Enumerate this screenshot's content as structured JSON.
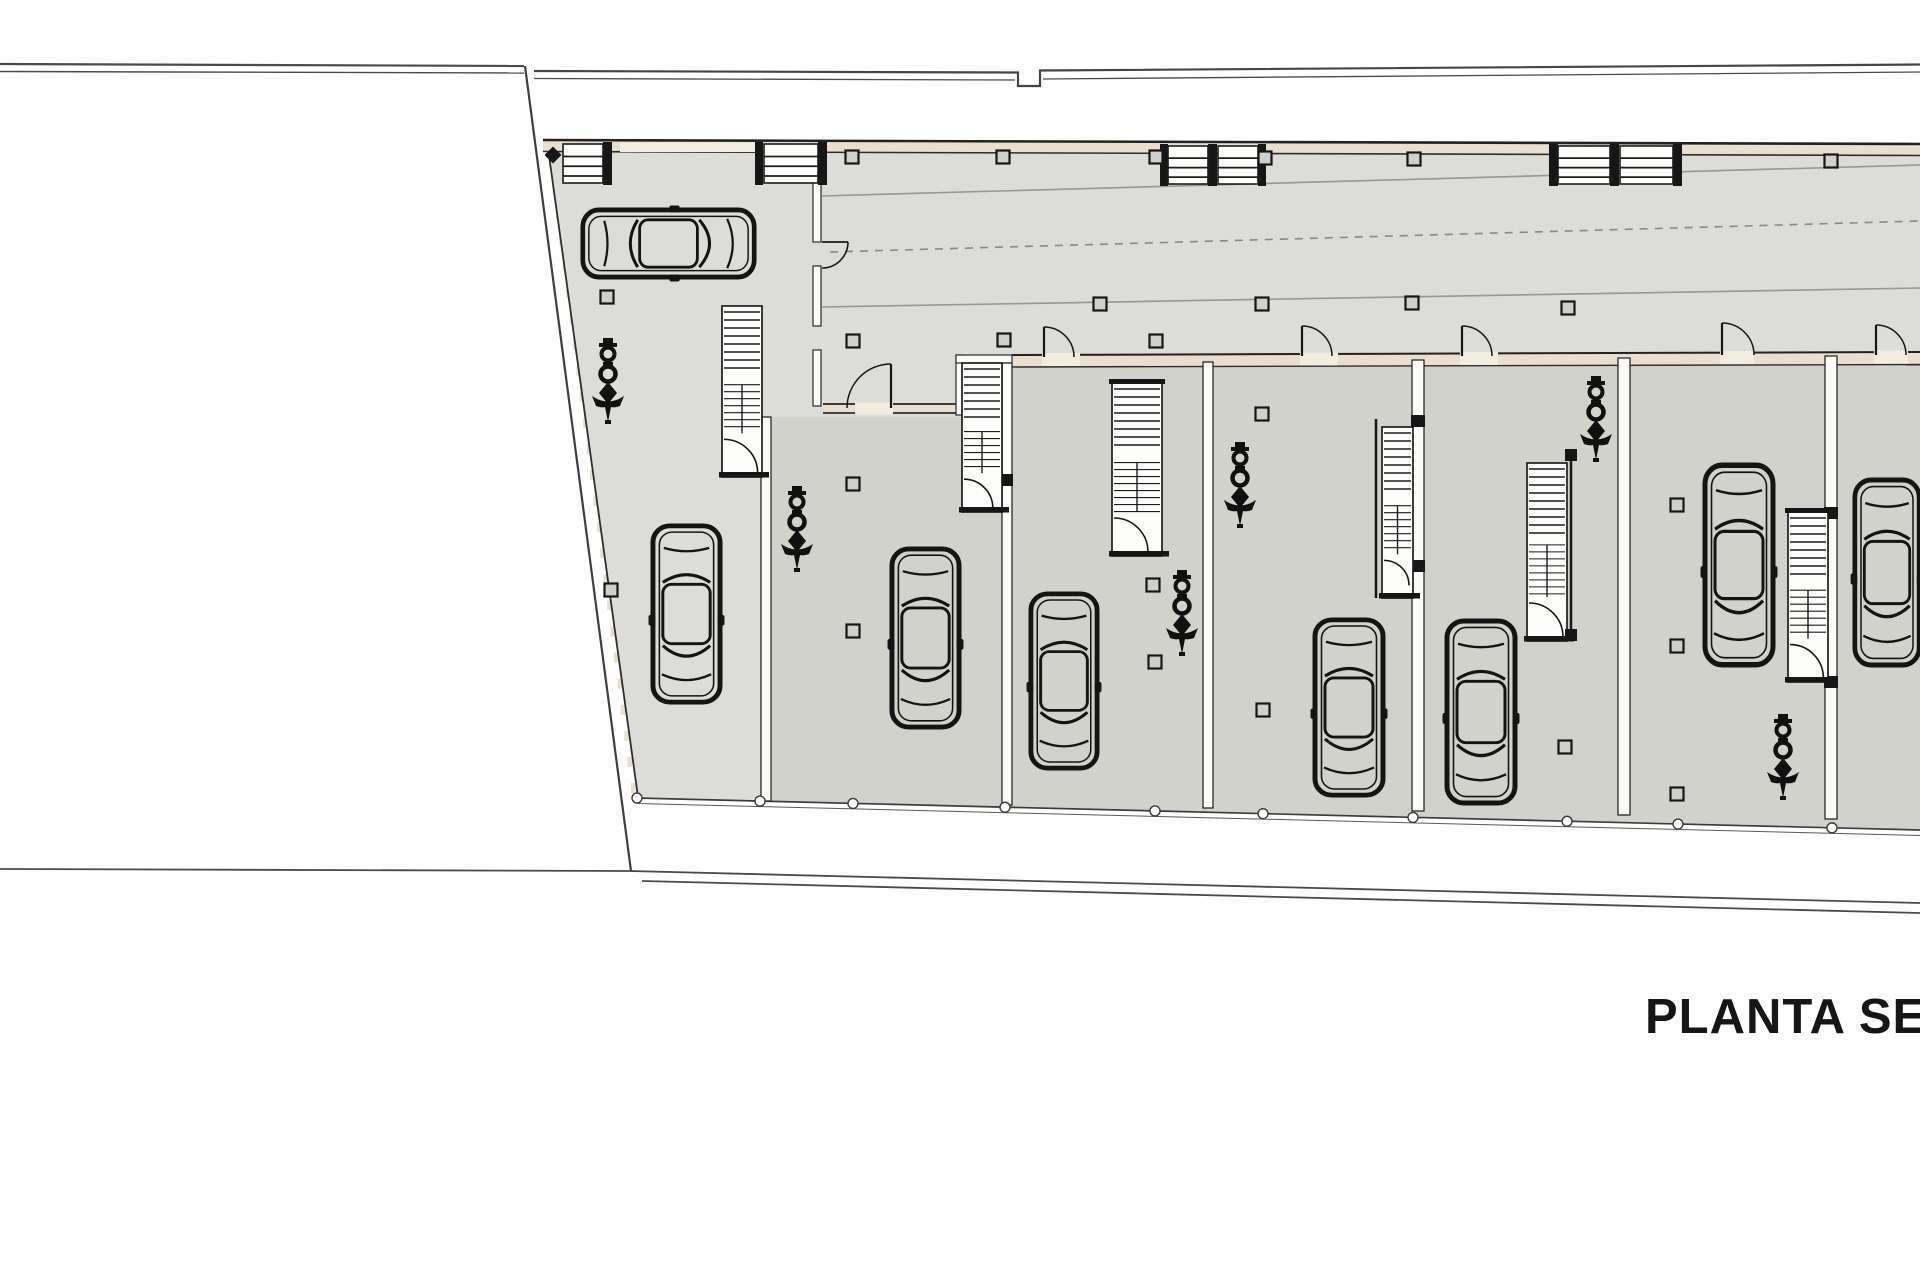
{
  "title": {
    "label": "PLANTA SEMIS"
  },
  "canvas": {
    "w": 1920,
    "h": 1280
  },
  "colors": {
    "background": "#ffffff",
    "floor_light": "#dcdcd8",
    "floor_unit": "#d2d2cc",
    "wall_fill": "#eadfcf",
    "wall_gap": "#f3ecdf",
    "white_wall": "#fcfbf8",
    "ink": "#1a1a1a",
    "boundary": "#4a4a4a",
    "lane": "#98988f"
  },
  "plan": {
    "building_outline": [
      [
        547,
        141
      ],
      [
        1920,
        145
      ],
      [
        1920,
        829
      ],
      [
        638,
        797
      ]
    ],
    "units_overlay": [
      [
        772,
        417
      ],
      [
        1002,
        417
      ],
      [
        1002,
        364
      ],
      [
        1920,
        356
      ],
      [
        1920,
        829
      ],
      [
        772,
        801
      ]
    ],
    "west_edge": {
      "x1": 551,
      "y1": 162,
      "x2": 633,
      "y2": 788,
      "dash_count": 24
    },
    "paths": [
      {
        "name": "boundary-top-left-outer",
        "d": "M0,64 L524,66",
        "w": 2.2,
        "c": "#4a4a4a"
      },
      {
        "name": "boundary-top-left-inner",
        "d": "M0,71.5 L524,73",
        "w": 1.4,
        "c": "#4a4a4a"
      },
      {
        "name": "boundary-top-right-outer",
        "d": "M534,71 L1018,72.5 L1018,86 L1040,86 L1040,70.5 L1920,64.5",
        "w": 2.2,
        "c": "#454545",
        "f": "none"
      },
      {
        "name": "boundary-top-right-inner-a",
        "d": "M534,78.5 L1015,80",
        "w": 1.3,
        "c": "#4a4a4a"
      },
      {
        "name": "boundary-top-right-inner-b",
        "d": "M1043,79 L1920,72",
        "w": 1.3,
        "c": "#4a4a4a"
      },
      {
        "name": "boundary-west-diagonal",
        "d": "M525,66 L631,871",
        "w": 2.2,
        "c": "#3f3f3f"
      },
      {
        "name": "boundary-bottom-left",
        "d": "M0,869 L629,871",
        "w": 1.8,
        "c": "#4a4a4a"
      },
      {
        "name": "boundary-bottom-right-outer",
        "d": "M629,871 L1920,903",
        "w": 1.8,
        "c": "#4a4a4a"
      },
      {
        "name": "boundary-bottom-right-inner",
        "d": "M642,881 L1920,913",
        "w": 1.8,
        "c": "#4a4a4a"
      },
      {
        "name": "building-west-edge",
        "d": "M547,141 L638,797",
        "w": 1.8,
        "c": "#2e2e2e"
      },
      {
        "name": "south-edge-outer",
        "d": "M637,798 L1920,830",
        "w": 1.7,
        "c": "#3c3c3c"
      },
      {
        "name": "south-edge-inner",
        "d": "M637,803.5 L1920,835.5",
        "w": 1,
        "c": "#5a5a5a"
      },
      {
        "name": "lane-upper-line",
        "d": "M822,196 L1920,165",
        "w": 1.6,
        "c": "#98988f"
      },
      {
        "name": "lane-center-dashed",
        "d": "M830,252 L1920,221",
        "w": 1.6,
        "c": "#8a8a82",
        "dash": "8 7"
      },
      {
        "name": "lane-lower-line",
        "d": "M822,307 L1920,288",
        "w": 1.6,
        "c": "#98988f"
      },
      {
        "name": "corridor-door-leaf",
        "d": "M822,242 L848,242",
        "w": 1.8,
        "c": "#1a1a1a"
      },
      {
        "name": "corridor-door-arc",
        "d": "M848,242 A26,26 0 0 1 822,268",
        "w": 1.6,
        "c": "#1a1a1a",
        "f": "none"
      }
    ],
    "wall_bands": [
      {
        "name": "north-wall",
        "pts": [
          [
            543,
            140
          ],
          [
            1920,
            144
          ],
          [
            1920,
            155.5
          ],
          [
            543,
            151.5
          ]
        ],
        "top": "M543,140 L1920,144",
        "bot": "M543,151.5 L1920,155.5",
        "tw": 2.6,
        "bw": 1.6
      },
      {
        "name": "unit2-top-wall",
        "pts": [
          [
            823,
            404
          ],
          [
            956,
            404
          ],
          [
            956,
            413
          ],
          [
            823,
            413
          ]
        ],
        "top": "M823,404 L956,404",
        "bot": "M823,413 L956,413",
        "tw": 1.8,
        "bw": 1.8
      },
      {
        "name": "units-top-wall",
        "pts": [
          [
            1012,
            355
          ],
          [
            1920,
            352
          ],
          [
            1920,
            364.5
          ],
          [
            1012,
            367
          ]
        ],
        "top": "M1012,355 L1920,352",
        "bot": "M1012,367 L1920,364.5",
        "tw": 2,
        "bw": 1.4
      }
    ],
    "wall_gaps": [
      {
        "name": "north-wall-garage-gap",
        "x": 620,
        "y": 142.5,
        "w": 137,
        "h": 9.5
      },
      {
        "name": "unit2-door-gap",
        "x": 855,
        "y": 402.5,
        "w": 38,
        "h": 12
      },
      {
        "name": "unit3-door-gap",
        "x": 1042,
        "y": 353,
        "w": 38,
        "h": 13
      },
      {
        "name": "unit4-door-gap",
        "x": 1300,
        "y": 352.5,
        "w": 38,
        "h": 13
      },
      {
        "name": "unit5-door-gap",
        "x": 1460,
        "y": 352,
        "w": 38,
        "h": 13
      },
      {
        "name": "unit6-door-gap",
        "x": 1720,
        "y": 351,
        "w": 34,
        "h": 13
      },
      {
        "name": "unit7-door-gap",
        "x": 1874,
        "y": 350.5,
        "w": 34,
        "h": 13
      }
    ],
    "thin_walls": [
      {
        "x": 813,
        "y": 153,
        "w": 8,
        "h": 89
      },
      {
        "x": 813,
        "y": 266,
        "w": 8,
        "h": 60
      },
      {
        "x": 813,
        "y": 350,
        "w": 8,
        "h": 56
      },
      {
        "x": 956,
        "y": 355,
        "w": 8,
        "h": 60
      },
      {
        "x": 956,
        "y": 355,
        "w": 56,
        "h": 8
      }
    ],
    "dividers": [
      {
        "x": 761,
        "y": 417,
        "w": 10,
        "h": 384,
        "blocks": []
      },
      {
        "x": 1002,
        "y": 363,
        "w": 10,
        "h": 442,
        "blocks": [
          474
        ]
      },
      {
        "x": 1203,
        "y": 362,
        "w": 10,
        "h": 446,
        "blocks": []
      },
      {
        "x": 1412,
        "y": 360,
        "w": 12,
        "h": 451,
        "blocks": [
          415,
          560
        ]
      },
      {
        "x": 1618,
        "y": 358,
        "w": 12,
        "h": 457,
        "blocks": []
      },
      {
        "x": 1825,
        "y": 356,
        "w": 12,
        "h": 463,
        "blocks": [
          507,
          676
        ]
      }
    ],
    "ladder_blocks": [
      {
        "x": 563,
        "y": 144,
        "w": 40,
        "h": 39
      },
      {
        "x": 764,
        "y": 144,
        "w": 54,
        "h": 39
      },
      {
        "x": 1168,
        "y": 146,
        "w": 40,
        "h": 38
      },
      {
        "x": 1218,
        "y": 146,
        "w": 40,
        "h": 38
      },
      {
        "x": 1558,
        "y": 146,
        "w": 52,
        "h": 38
      },
      {
        "x": 1620,
        "y": 146,
        "w": 53,
        "h": 38
      }
    ],
    "ladder_posts": [
      {
        "x": 603,
        "y": 142,
        "w": 9,
        "h": 43
      },
      {
        "x": 755,
        "y": 142,
        "w": 8,
        "h": 43
      },
      {
        "x": 818,
        "y": 142,
        "w": 9,
        "h": 43
      },
      {
        "x": 1160,
        "y": 144,
        "w": 8,
        "h": 42
      },
      {
        "x": 1208,
        "y": 144,
        "w": 9,
        "h": 42
      },
      {
        "x": 1258,
        "y": 144,
        "w": 8,
        "h": 42
      },
      {
        "x": 1549,
        "y": 144,
        "w": 9,
        "h": 42
      },
      {
        "x": 1610,
        "y": 144,
        "w": 9,
        "h": 42
      },
      {
        "x": 1673,
        "y": 144,
        "w": 9,
        "h": 42
      }
    ],
    "stairs": [
      {
        "x": 722,
        "y": 306,
        "w": 40,
        "h": 171
      },
      {
        "x": 962,
        "y": 363,
        "w": 40,
        "h": 149
      },
      {
        "x": 1112,
        "y": 383,
        "w": 50,
        "h": 173,
        "topBar": true
      },
      {
        "x": 1382,
        "y": 427,
        "w": 31,
        "h": 171,
        "railL": true
      },
      {
        "x": 1527,
        "y": 463,
        "w": 40,
        "h": 178,
        "railR": true
      },
      {
        "x": 1788,
        "y": 512,
        "w": 40,
        "h": 170,
        "topBar": true
      }
    ],
    "door_arcs": [
      {
        "x": 1044,
        "y": 357,
        "r": 30,
        "sweep": 1
      },
      {
        "x": 1302,
        "y": 356,
        "r": 30,
        "sweep": 1
      },
      {
        "x": 1462,
        "y": 356,
        "r": 30,
        "sweep": 1
      },
      {
        "x": 1722,
        "y": 355,
        "r": 32,
        "sweep": 1
      },
      {
        "x": 1876,
        "y": 355,
        "r": 30,
        "sweep": 1
      },
      {
        "x": 891,
        "y": 408,
        "r": 44,
        "sweep": 0
      }
    ],
    "columns": [
      [
        852,
        157
      ],
      [
        1003,
        157
      ],
      [
        1156,
        157
      ],
      [
        1265,
        158
      ],
      [
        1414,
        159
      ],
      [
        1831,
        161
      ],
      [
        607,
        297
      ],
      [
        611,
        590
      ],
      [
        853,
        341
      ],
      [
        853,
        484
      ],
      [
        853,
        631
      ],
      [
        1004,
        340
      ],
      [
        1100,
        304
      ],
      [
        1153,
        585
      ],
      [
        1155,
        662
      ],
      [
        1156,
        341
      ],
      [
        1262,
        304
      ],
      [
        1262,
        414
      ],
      [
        1263,
        710
      ],
      [
        1412,
        303
      ],
      [
        1565,
        747
      ],
      [
        1568,
        308
      ],
      [
        1677,
        505
      ],
      [
        1677,
        646
      ],
      [
        1677,
        794
      ]
    ],
    "south_posts": [
      637,
      760,
      853,
      1005,
      1155,
      1263,
      1413,
      1567,
      1678,
      1832
    ],
    "cars": [
      {
        "x": 580,
        "y": 207,
        "w": 177,
        "h": 73,
        "dir": "right"
      },
      {
        "x": 650,
        "y": 523,
        "w": 73,
        "h": 182,
        "dir": "down"
      },
      {
        "x": 889,
        "y": 546,
        "w": 73,
        "h": 184,
        "dir": "down"
      },
      {
        "x": 1028,
        "y": 591,
        "w": 72,
        "h": 180,
        "dir": "down"
      },
      {
        "x": 1312,
        "y": 617,
        "w": 74,
        "h": 181,
        "dir": "down"
      },
      {
        "x": 1444,
        "y": 618,
        "w": 74,
        "h": 188,
        "dir": "down"
      },
      {
        "x": 1702,
        "y": 462,
        "w": 74,
        "h": 206,
        "dir": "down"
      },
      {
        "x": 1852,
        "y": 477,
        "w": 70,
        "h": 191,
        "dir": "down"
      }
    ],
    "ornaments": [
      {
        "cx": 608,
        "y": 336
      },
      {
        "cx": 797,
        "y": 484
      },
      {
        "cx": 1240,
        "y": 440
      },
      {
        "cx": 1182,
        "y": 568
      },
      {
        "cx": 1596,
        "y": 374
      },
      {
        "cx": 1783,
        "y": 712
      }
    ],
    "markers": [
      {
        "x": 553,
        "y": 155
      }
    ]
  }
}
